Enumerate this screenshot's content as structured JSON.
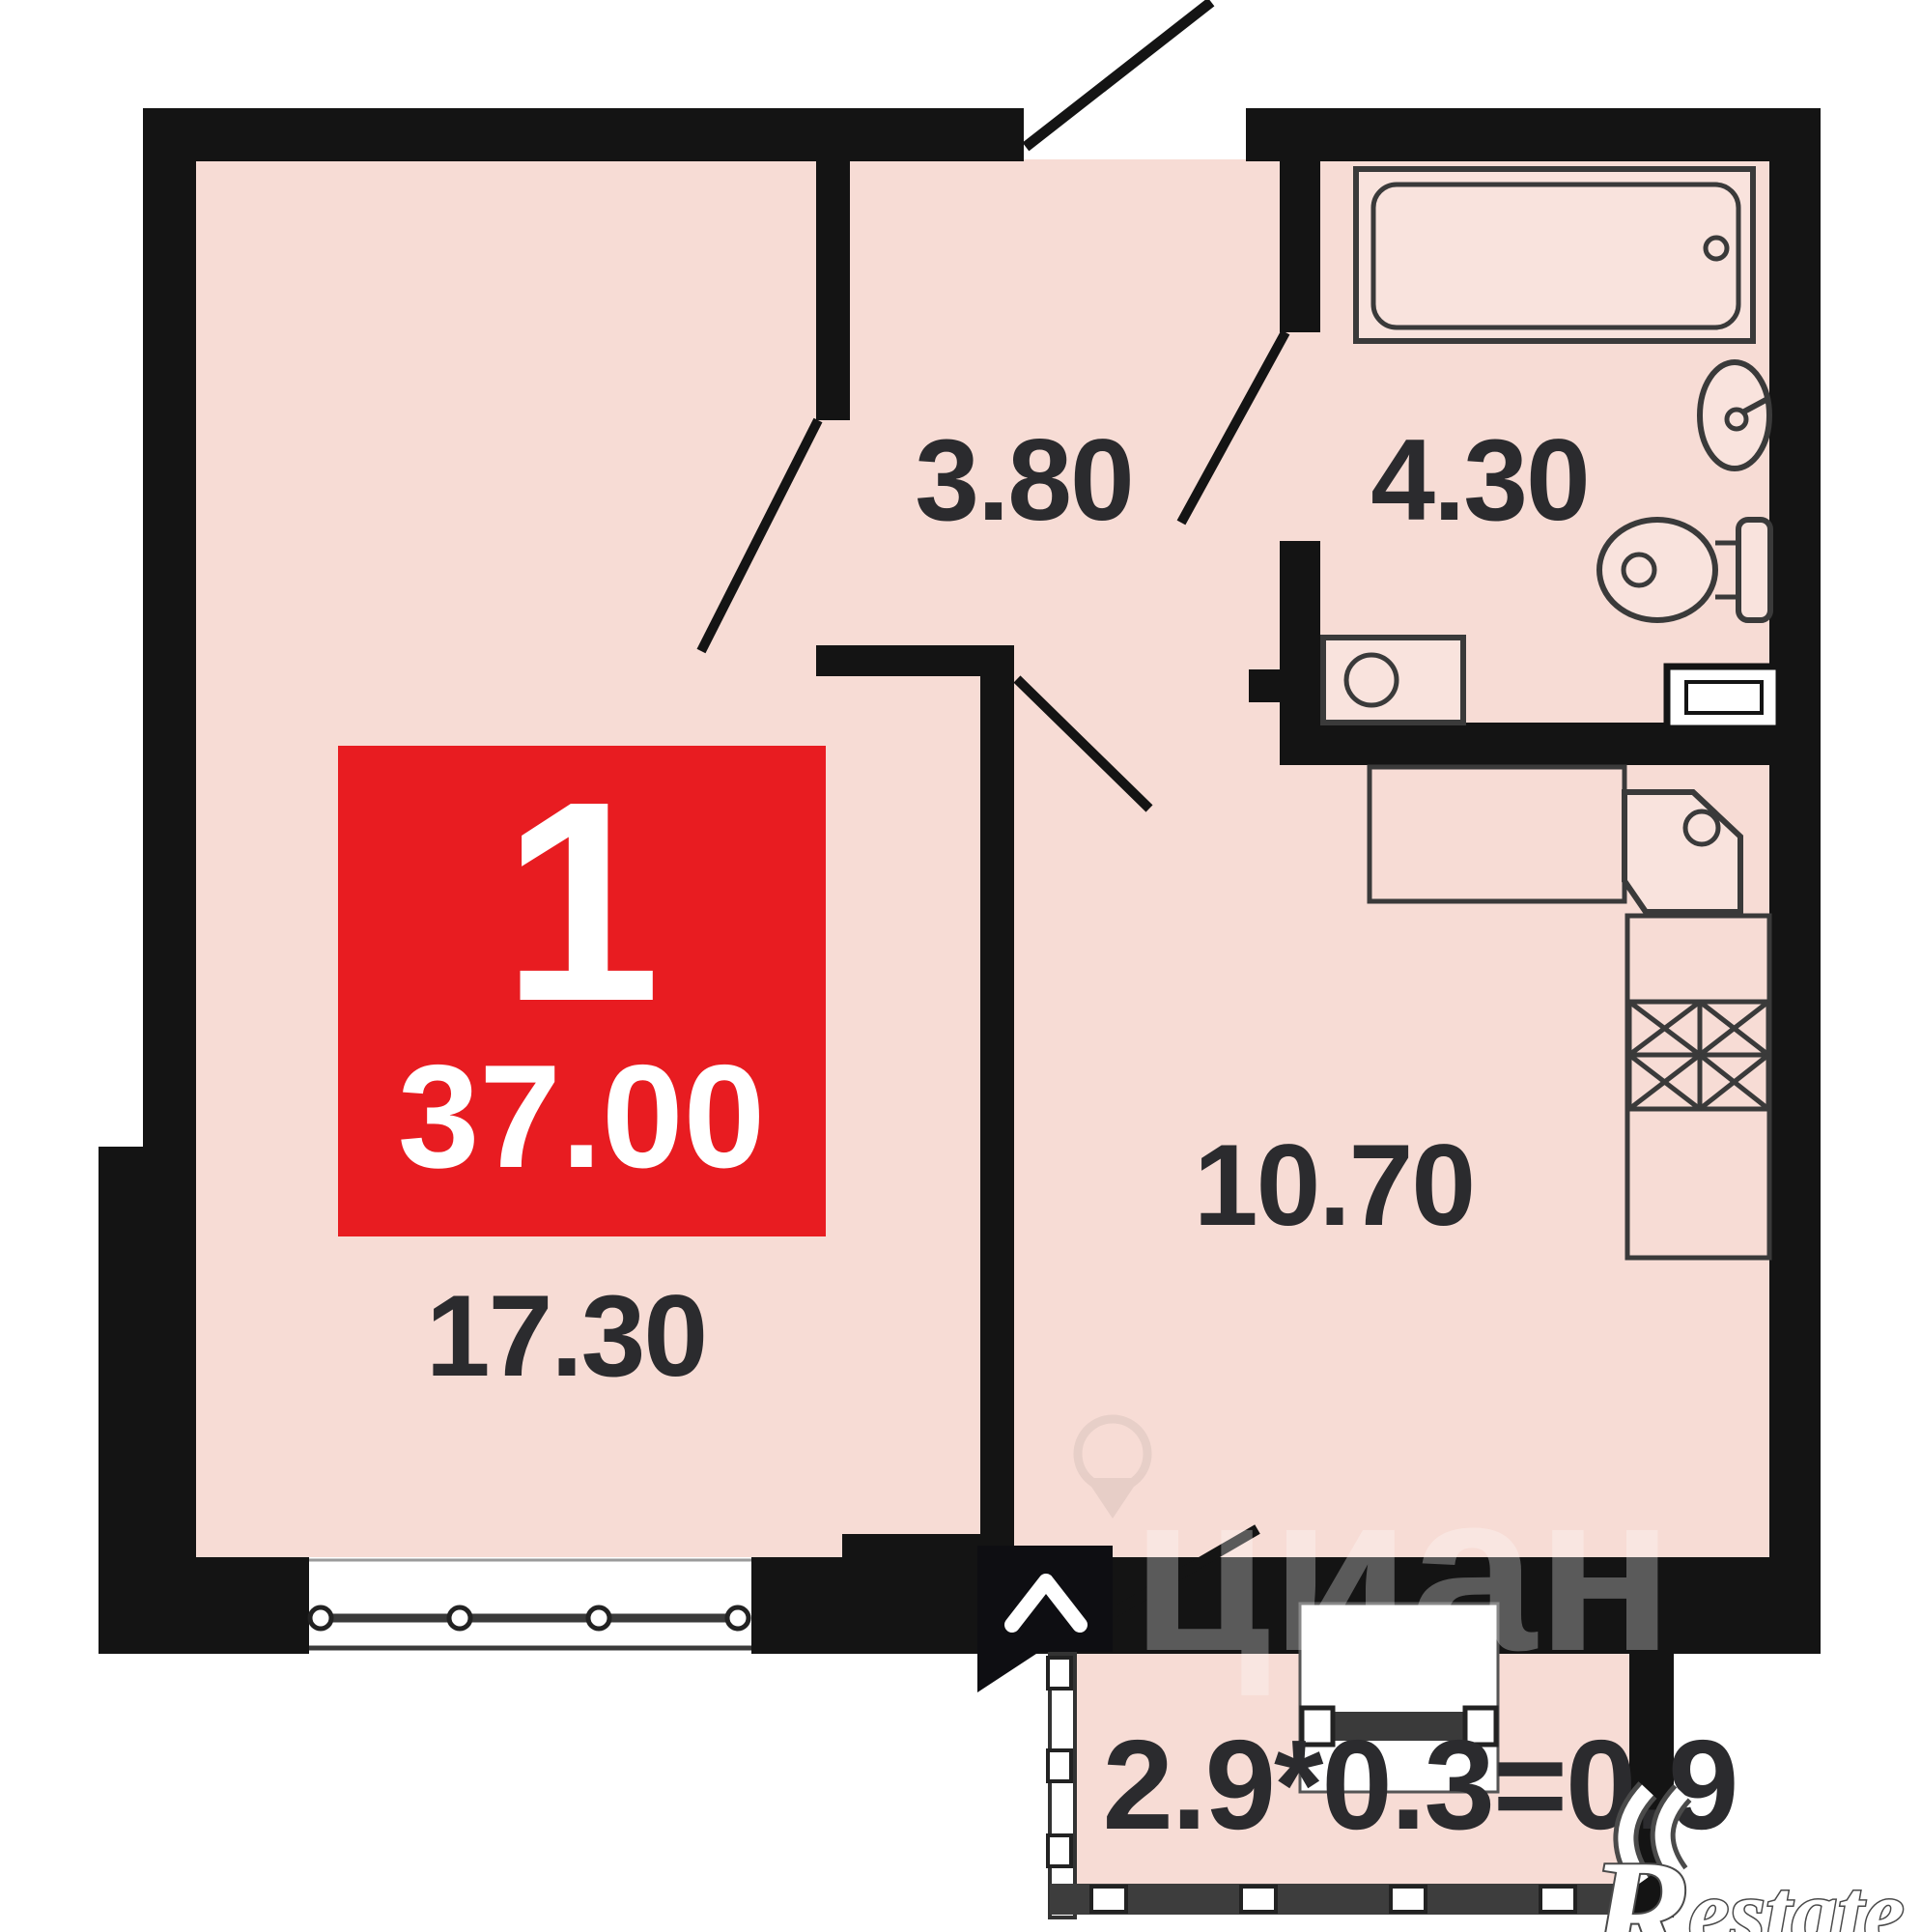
{
  "floorplan": {
    "badge": {
      "rooms_count": "1",
      "total_area": "37.00",
      "color": "#e81c21"
    },
    "rooms": {
      "living": {
        "area": "17.30"
      },
      "hallway": {
        "area": "3.80"
      },
      "bathroom": {
        "area": "4.30"
      },
      "kitchen": {
        "area": "10.70"
      },
      "balcony": {
        "area_formula": "2.9*0.3=0.9"
      }
    },
    "colors": {
      "wall": "#141414",
      "floor": "#f7dcd5",
      "fixture_fill": "#f9e3dd",
      "label": "#2b2b2e",
      "badge_red": "#e81c21"
    },
    "watermarks": {
      "cian": "циан",
      "restate_initial": "R",
      "restate_rest": "estate"
    }
  }
}
